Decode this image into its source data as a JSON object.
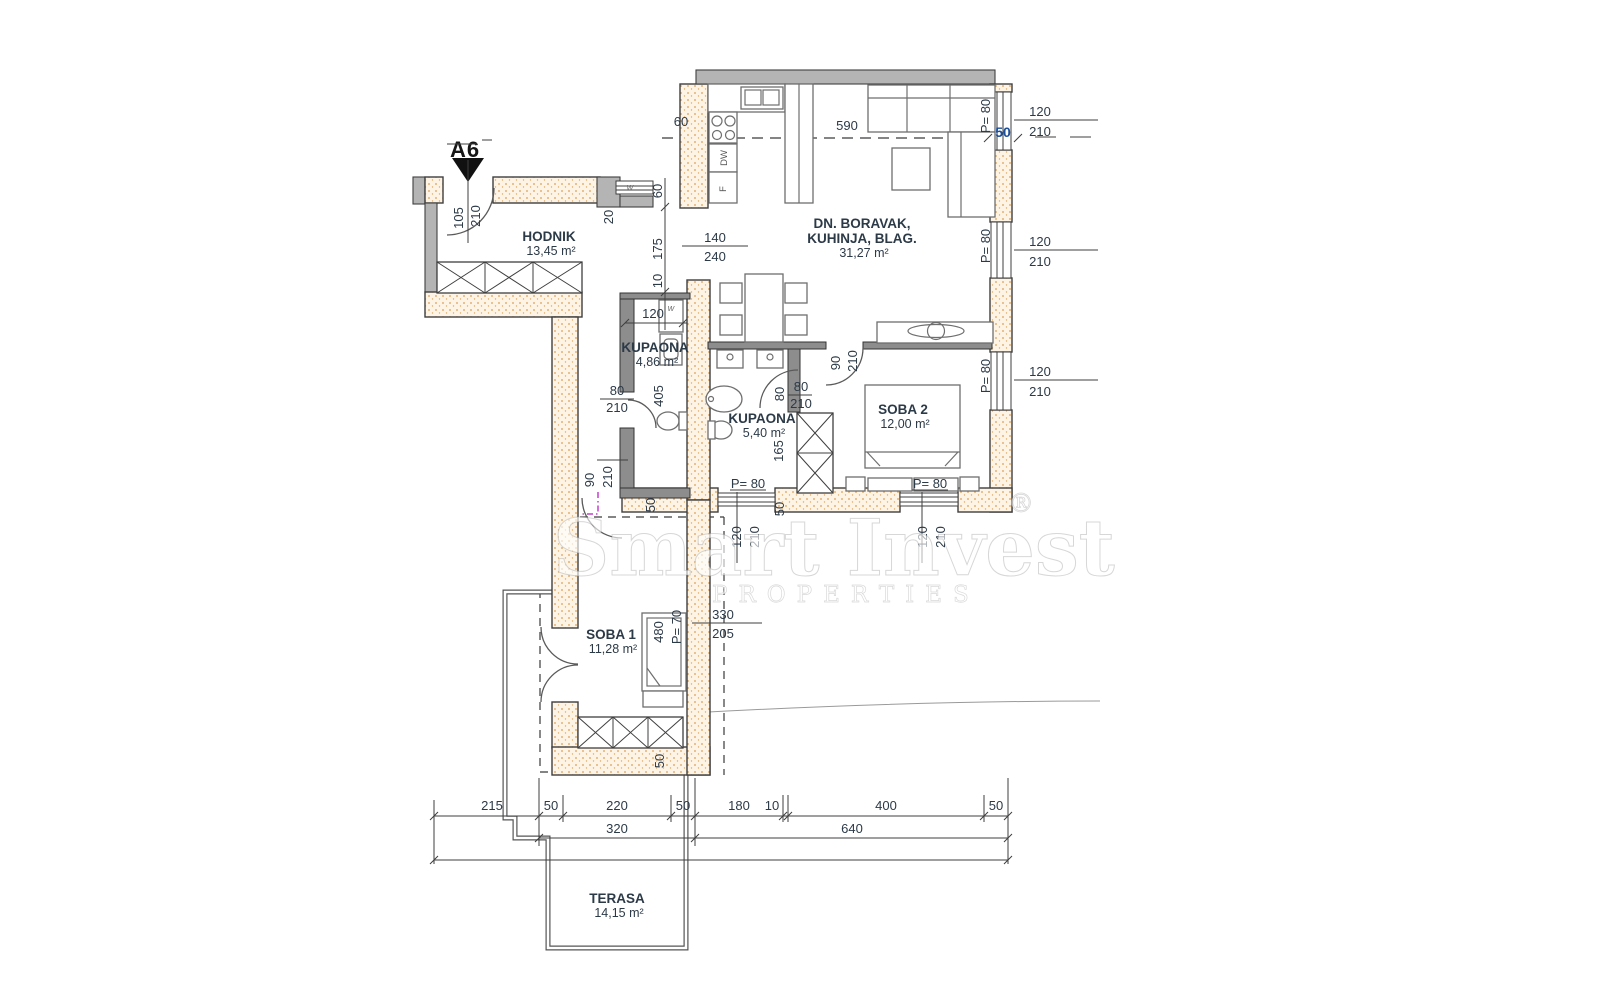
{
  "marker": {
    "label": "A6"
  },
  "watermark": {
    "line1": "Smart Invest",
    "reg": "®",
    "line2": "PROPERTIES"
  },
  "colors": {
    "accent_blue": "#1b4f9c",
    "text": "#2c3a48",
    "magenta": "#c63fd0",
    "wall_dot": "#dd9e56",
    "wall_fill": "#fdf4e5"
  },
  "rooms": [
    {
      "name": "HODNIK",
      "area": "13,45 m²",
      "x": 549,
      "y": 241
    },
    {
      "name": "DN. BORAVAK,",
      "name2": "KUHINJA, BLAG.",
      "area": "31,27 m²",
      "x": 862,
      "y": 228
    },
    {
      "name": "KUPAONA",
      "area": "4,86 m²",
      "x": 655,
      "y": 352
    },
    {
      "name": "KUPAONA",
      "area": "5,40 m²",
      "x": 762,
      "y": 423
    },
    {
      "name": "SOBA 2",
      "area": "12,00 m²",
      "x": 903,
      "y": 414
    },
    {
      "name": "SOBA 1",
      "area": "11,28 m²",
      "x": 611,
      "y": 639
    },
    {
      "name": "TERASA",
      "area": "14,15 m²",
      "x": 617,
      "y": 903
    }
  ],
  "labels": [
    {
      "t": "60",
      "x": 681,
      "y": 126
    },
    {
      "t": "590",
      "x": 847,
      "y": 130
    },
    {
      "t": "50",
      "x": 1003,
      "y": 137,
      "c": "blue"
    },
    {
      "t": "120",
      "x": 1040,
      "y": 116
    },
    {
      "t": "210",
      "x": 1040,
      "y": 136
    },
    {
      "t": "120",
      "x": 1040,
      "y": 246
    },
    {
      "t": "210",
      "x": 1040,
      "y": 266
    },
    {
      "t": "120",
      "x": 1040,
      "y": 376
    },
    {
      "t": "210",
      "x": 1040,
      "y": 396
    },
    {
      "t": "P= 80",
      "x": 990,
      "y": 116,
      "r": -90
    },
    {
      "t": "P= 80",
      "x": 990,
      "y": 246,
      "r": -90
    },
    {
      "t": "P= 80",
      "x": 990,
      "y": 376,
      "r": -90
    },
    {
      "t": "105",
      "x": 463,
      "y": 218,
      "r": -90
    },
    {
      "t": "210",
      "x": 480,
      "y": 216,
      "r": -90
    },
    {
      "t": "20",
      "x": 613,
      "y": 217,
      "r": -90
    },
    {
      "t": "60",
      "x": 662,
      "y": 191,
      "r": -90
    },
    {
      "t": "175",
      "x": 662,
      "y": 249,
      "r": -90
    },
    {
      "t": "10",
      "x": 662,
      "y": 281,
      "r": -90
    },
    {
      "t": "140",
      "x": 715,
      "y": 242
    },
    {
      "t": "240",
      "x": 715,
      "y": 261
    },
    {
      "t": "120",
      "x": 653,
      "y": 318
    },
    {
      "t": "w",
      "x": 630,
      "y": 190,
      "c": "tiny"
    },
    {
      "t": "w",
      "x": 671,
      "y": 311,
      "c": "tiny"
    },
    {
      "t": "80",
      "x": 617,
      "y": 395
    },
    {
      "t": "210",
      "x": 617,
      "y": 412
    },
    {
      "t": "405",
      "x": 663,
      "y": 396,
      "r": -90
    },
    {
      "t": "90",
      "x": 594,
      "y": 480,
      "r": -90
    },
    {
      "t": "210",
      "x": 612,
      "y": 477,
      "r": -90
    },
    {
      "t": "80",
      "x": 784,
      "y": 394,
      "r": -90
    },
    {
      "t": "80",
      "x": 801,
      "y": 391
    },
    {
      "t": "210",
      "x": 801,
      "y": 408
    },
    {
      "t": "165",
      "x": 783,
      "y": 451,
      "r": -90
    },
    {
      "t": "90",
      "x": 840,
      "y": 363,
      "r": -90
    },
    {
      "t": "210",
      "x": 857,
      "y": 361,
      "r": -90
    },
    {
      "t": "P= 80",
      "x": 748,
      "y": 488
    },
    {
      "t": "P= 80",
      "x": 930,
      "y": 488
    },
    {
      "t": "50",
      "x": 655,
      "y": 505,
      "r": -90
    },
    {
      "t": "50",
      "x": 784,
      "y": 509,
      "r": -90
    },
    {
      "t": "120",
      "x": 741,
      "y": 537,
      "r": -90
    },
    {
      "t": "210",
      "x": 759,
      "y": 537,
      "r": -90
    },
    {
      "t": "120",
      "x": 927,
      "y": 537,
      "r": -90
    },
    {
      "t": "210",
      "x": 945,
      "y": 537,
      "r": -90
    },
    {
      "t": "330",
      "x": 723,
      "y": 619
    },
    {
      "t": "205",
      "x": 723,
      "y": 638
    },
    {
      "t": "480",
      "x": 663,
      "y": 632,
      "r": -90
    },
    {
      "t": "P= 70",
      "x": 681,
      "y": 627,
      "r": -90
    },
    {
      "t": "50",
      "x": 664,
      "y": 761,
      "r": -90
    },
    {
      "t": "DW",
      "x": 727,
      "y": 158,
      "r": -90,
      "c": "tiny2"
    },
    {
      "t": "F",
      "x": 726,
      "y": 189,
      "r": -90,
      "c": "tiny2"
    },
    {
      "t": "215",
      "x": 492,
      "y": 810
    },
    {
      "t": "50",
      "x": 551,
      "y": 810
    },
    {
      "t": "220",
      "x": 617,
      "y": 810
    },
    {
      "t": "50",
      "x": 683,
      "y": 810
    },
    {
      "t": "180",
      "x": 739,
      "y": 810
    },
    {
      "t": "10",
      "x": 772,
      "y": 810
    },
    {
      "t": "400",
      "x": 886,
      "y": 810
    },
    {
      "t": "50",
      "x": 996,
      "y": 810
    },
    {
      "t": "320",
      "x": 617,
      "y": 833
    },
    {
      "t": "640",
      "x": 852,
      "y": 833
    }
  ]
}
